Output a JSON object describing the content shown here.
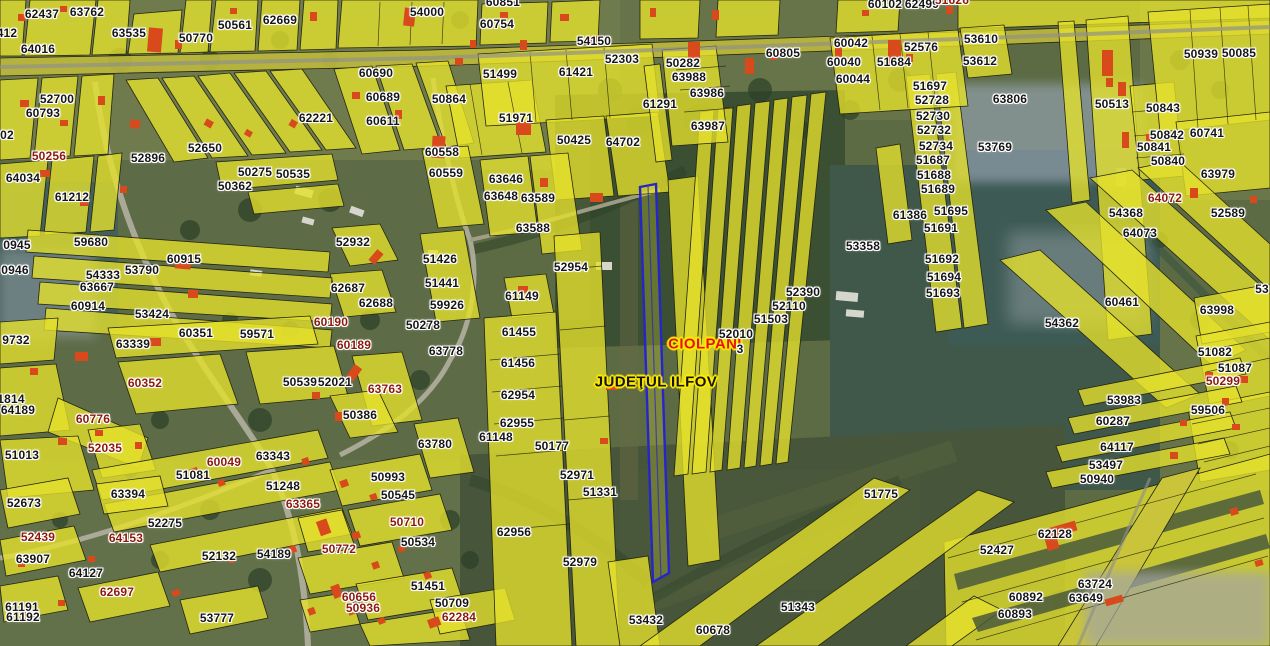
{
  "map": {
    "type": "cadastral-parcel-viewer",
    "basemap": "aerial-orthophoto",
    "overlay": "cadastral-parcels-yellow",
    "selected_parcel_outline": "#2525cc"
  },
  "colors": {
    "parcel_fill": "#e6e22c",
    "parcel_stroke": "#25250f",
    "building_red": "#d84a1c",
    "label_black": "#161616",
    "label_red": "#8c1a0c",
    "label_halo": "#ffffff",
    "town_red": "#e81212",
    "halo_yellow": "#ffec00",
    "selected_blue": "#2525cc"
  },
  "place_labels": [
    {
      "text": "CIOLPANI",
      "x": 705,
      "y": 344,
      "type": "locality"
    },
    {
      "text": "JUDEŢUL ILFOV",
      "x": 656,
      "y": 382,
      "type": "county"
    }
  ],
  "parcel_labels": [
    {
      "t": "62437",
      "x": 42,
      "y": 14
    },
    {
      "t": "63762",
      "x": 87,
      "y": 12
    },
    {
      "t": "412",
      "x": 7,
      "y": 33
    },
    {
      "t": "64016",
      "x": 38,
      "y": 49
    },
    {
      "t": "63535",
      "x": 129,
      "y": 33
    },
    {
      "t": "50770",
      "x": 196,
      "y": 38
    },
    {
      "t": "50561",
      "x": 235,
      "y": 25
    },
    {
      "t": "62669",
      "x": 280,
      "y": 20
    },
    {
      "t": "54000",
      "x": 427,
      "y": 12
    },
    {
      "t": "60851",
      "x": 503,
      "y": 2
    },
    {
      "t": "60754",
      "x": 497,
      "y": 24
    },
    {
      "t": "54150",
      "x": 594,
      "y": 41
    },
    {
      "t": "52303",
      "x": 622,
      "y": 59
    },
    {
      "t": "60102",
      "x": 885,
      "y": 4
    },
    {
      "t": "62499",
      "x": 922,
      "y": 4
    },
    {
      "t": "51626",
      "x": 952,
      "y": 0,
      "r": 1
    },
    {
      "t": "60805",
      "x": 783,
      "y": 53
    },
    {
      "t": "60042",
      "x": 851,
      "y": 43
    },
    {
      "t": "60040",
      "x": 844,
      "y": 62
    },
    {
      "t": "60044",
      "x": 853,
      "y": 79
    },
    {
      "t": "51684",
      "x": 894,
      "y": 62
    },
    {
      "t": "52576",
      "x": 921,
      "y": 47
    },
    {
      "t": "53610",
      "x": 981,
      "y": 39
    },
    {
      "t": "53612",
      "x": 980,
      "y": 61
    },
    {
      "t": "50939",
      "x": 1201,
      "y": 54
    },
    {
      "t": "50085",
      "x": 1239,
      "y": 53
    },
    {
      "t": "50282",
      "x": 683,
      "y": 63
    },
    {
      "t": "63988",
      "x": 689,
      "y": 77
    },
    {
      "t": "63986",
      "x": 707,
      "y": 93
    },
    {
      "t": "63987",
      "x": 708,
      "y": 126
    },
    {
      "t": "61291",
      "x": 660,
      "y": 104
    },
    {
      "t": "63806",
      "x": 1010,
      "y": 99
    },
    {
      "t": "51697",
      "x": 930,
      "y": 86
    },
    {
      "t": "52728",
      "x": 932,
      "y": 100
    },
    {
      "t": "52730",
      "x": 933,
      "y": 116
    },
    {
      "t": "52732",
      "x": 934,
      "y": 130
    },
    {
      "t": "52734",
      "x": 936,
      "y": 146
    },
    {
      "t": "51687",
      "x": 933,
      "y": 160
    },
    {
      "t": "51688",
      "x": 934,
      "y": 175
    },
    {
      "t": "51689",
      "x": 938,
      "y": 189
    },
    {
      "t": "50513",
      "x": 1112,
      "y": 104
    },
    {
      "t": "50843",
      "x": 1163,
      "y": 108
    },
    {
      "t": "50842",
      "x": 1167,
      "y": 135
    },
    {
      "t": "50841",
      "x": 1154,
      "y": 147
    },
    {
      "t": "50840",
      "x": 1168,
      "y": 161
    },
    {
      "t": "60741",
      "x": 1207,
      "y": 133
    },
    {
      "t": "63979",
      "x": 1218,
      "y": 174
    },
    {
      "t": "52700",
      "x": 57,
      "y": 99
    },
    {
      "t": "60793",
      "x": 43,
      "y": 113
    },
    {
      "t": "02",
      "x": 7,
      "y": 135
    },
    {
      "t": "50256",
      "x": 49,
      "y": 156,
      "r": 1
    },
    {
      "t": "52896",
      "x": 148,
      "y": 158
    },
    {
      "t": "52650",
      "x": 205,
      "y": 148
    },
    {
      "t": "62221",
      "x": 316,
      "y": 118
    },
    {
      "t": "60690",
      "x": 376,
      "y": 73
    },
    {
      "t": "60689",
      "x": 383,
      "y": 97
    },
    {
      "t": "60611",
      "x": 383,
      "y": 121
    },
    {
      "t": "50864",
      "x": 449,
      "y": 99
    },
    {
      "t": "51499",
      "x": 500,
      "y": 74
    },
    {
      "t": "51971",
      "x": 516,
      "y": 118
    },
    {
      "t": "61421",
      "x": 576,
      "y": 72
    },
    {
      "t": "60558",
      "x": 442,
      "y": 152
    },
    {
      "t": "60559",
      "x": 446,
      "y": 173
    },
    {
      "t": "50425",
      "x": 574,
      "y": 140
    },
    {
      "t": "64702",
      "x": 623,
      "y": 142
    },
    {
      "t": "63646",
      "x": 506,
      "y": 179
    },
    {
      "t": "63648",
      "x": 501,
      "y": 196
    },
    {
      "t": "63589",
      "x": 538,
      "y": 198
    },
    {
      "t": "63588",
      "x": 533,
      "y": 228
    },
    {
      "t": "50275",
      "x": 255,
      "y": 172
    },
    {
      "t": "50362",
      "x": 235,
      "y": 186
    },
    {
      "t": "50535",
      "x": 293,
      "y": 174
    },
    {
      "t": "64034",
      "x": 23,
      "y": 178
    },
    {
      "t": "61212",
      "x": 72,
      "y": 197
    },
    {
      "t": "53769",
      "x": 995,
      "y": 147
    },
    {
      "t": "59680",
      "x": 91,
      "y": 242
    },
    {
      "t": "53790",
      "x": 142,
      "y": 270
    },
    {
      "t": "54333",
      "x": 103,
      "y": 275
    },
    {
      "t": "63667",
      "x": 97,
      "y": 287
    },
    {
      "t": "60914",
      "x": 88,
      "y": 306
    },
    {
      "t": "53424",
      "x": 152,
      "y": 314
    },
    {
      "t": "60915",
      "x": 184,
      "y": 259
    },
    {
      "t": "52932",
      "x": 353,
      "y": 242
    },
    {
      "t": "51426",
      "x": 440,
      "y": 259
    },
    {
      "t": "51441",
      "x": 442,
      "y": 283
    },
    {
      "t": "59926",
      "x": 447,
      "y": 305
    },
    {
      "t": "62687",
      "x": 348,
      "y": 288
    },
    {
      "t": "62688",
      "x": 376,
      "y": 303
    },
    {
      "t": "52954",
      "x": 571,
      "y": 267
    },
    {
      "t": "61149",
      "x": 522,
      "y": 296
    },
    {
      "t": "53358",
      "x": 863,
      "y": 246
    },
    {
      "t": "61386",
      "x": 910,
      "y": 215
    },
    {
      "t": "51695",
      "x": 951,
      "y": 211
    },
    {
      "t": "51691",
      "x": 941,
      "y": 228
    },
    {
      "t": "51692",
      "x": 942,
      "y": 259
    },
    {
      "t": "51694",
      "x": 944,
      "y": 277
    },
    {
      "t": "51693",
      "x": 943,
      "y": 293
    },
    {
      "t": "52390",
      "x": 803,
      "y": 292
    },
    {
      "t": "52110",
      "x": 789,
      "y": 306
    },
    {
      "t": "51503",
      "x": 771,
      "y": 319
    },
    {
      "t": "52010",
      "x": 736,
      "y": 334
    },
    {
      "t": "3",
      "x": 740,
      "y": 349
    },
    {
      "t": "54368",
      "x": 1126,
      "y": 213
    },
    {
      "t": "64072",
      "x": 1165,
      "y": 198,
      "r": 1
    },
    {
      "t": "64073",
      "x": 1140,
      "y": 233
    },
    {
      "t": "52589",
      "x": 1228,
      "y": 213
    },
    {
      "t": "60461",
      "x": 1122,
      "y": 302
    },
    {
      "t": "54362",
      "x": 1062,
      "y": 323
    },
    {
      "t": "63998",
      "x": 1217,
      "y": 310
    },
    {
      "t": "0945",
      "x": 17,
      "y": 245
    },
    {
      "t": "0946",
      "x": 15,
      "y": 270
    },
    {
      "t": "60190",
      "x": 331,
      "y": 322,
      "r": 1
    },
    {
      "t": "60189",
      "x": 354,
      "y": 345,
      "r": 1
    },
    {
      "t": "50278",
      "x": 423,
      "y": 325
    },
    {
      "t": "63778",
      "x": 446,
      "y": 351
    },
    {
      "t": "61455",
      "x": 519,
      "y": 332
    },
    {
      "t": "61456",
      "x": 518,
      "y": 363
    },
    {
      "t": "62954",
      "x": 518,
      "y": 395
    },
    {
      "t": "62955",
      "x": 517,
      "y": 423
    },
    {
      "t": "61148",
      "x": 496,
      "y": 437
    },
    {
      "t": "50177",
      "x": 552,
      "y": 446
    },
    {
      "t": "9732",
      "x": 16,
      "y": 340
    },
    {
      "t": "63339",
      "x": 133,
      "y": 344
    },
    {
      "t": "60351",
      "x": 196,
      "y": 333
    },
    {
      "t": "59571",
      "x": 257,
      "y": 334
    },
    {
      "t": "60352",
      "x": 145,
      "y": 383,
      "r": 1
    },
    {
      "t": "50539",
      "x": 300,
      "y": 382
    },
    {
      "t": "52021",
      "x": 335,
      "y": 382
    },
    {
      "t": "1814",
      "x": 11,
      "y": 399
    },
    {
      "t": "64189",
      "x": 18,
      "y": 410
    },
    {
      "t": "60776",
      "x": 93,
      "y": 419,
      "r": 1
    },
    {
      "t": "51013",
      "x": 22,
      "y": 455
    },
    {
      "t": "52035",
      "x": 105,
      "y": 448,
      "r": 1
    },
    {
      "t": "63763",
      "x": 385,
      "y": 389,
      "r": 1
    },
    {
      "t": "50386",
      "x": 360,
      "y": 415
    },
    {
      "t": "63780",
      "x": 435,
      "y": 444
    },
    {
      "t": "60049",
      "x": 224,
      "y": 462,
      "r": 1
    },
    {
      "t": "63343",
      "x": 273,
      "y": 456
    },
    {
      "t": "51081",
      "x": 193,
      "y": 475
    },
    {
      "t": "50993",
      "x": 388,
      "y": 477
    },
    {
      "t": "51248",
      "x": 283,
      "y": 486
    },
    {
      "t": "50545",
      "x": 398,
      "y": 495
    },
    {
      "t": "52971",
      "x": 577,
      "y": 475
    },
    {
      "t": "51331",
      "x": 600,
      "y": 492
    },
    {
      "t": "51082",
      "x": 1215,
      "y": 352
    },
    {
      "t": "51087",
      "x": 1235,
      "y": 368
    },
    {
      "t": "50299",
      "x": 1223,
      "y": 381,
      "r": 1
    },
    {
      "t": "53983",
      "x": 1124,
      "y": 400
    },
    {
      "t": "59506",
      "x": 1208,
      "y": 410
    },
    {
      "t": "60287",
      "x": 1113,
      "y": 421
    },
    {
      "t": "64117",
      "x": 1117,
      "y": 447
    },
    {
      "t": "53497",
      "x": 1106,
      "y": 465
    },
    {
      "t": "50940",
      "x": 1097,
      "y": 479
    },
    {
      "t": "51775",
      "x": 881,
      "y": 494
    },
    {
      "t": "63394",
      "x": 128,
      "y": 494
    },
    {
      "t": "52673",
      "x": 24,
      "y": 503
    },
    {
      "t": "63365",
      "x": 303,
      "y": 504,
      "r": 1
    },
    {
      "t": "52439",
      "x": 38,
      "y": 537,
      "r": 1
    },
    {
      "t": "52275",
      "x": 165,
      "y": 523
    },
    {
      "t": "64153",
      "x": 126,
      "y": 538,
      "r": 1
    },
    {
      "t": "63907",
      "x": 33,
      "y": 559
    },
    {
      "t": "64127",
      "x": 86,
      "y": 573
    },
    {
      "t": "62697",
      "x": 117,
      "y": 592,
      "r": 1
    },
    {
      "t": "61191",
      "x": 22,
      "y": 607
    },
    {
      "t": "61192",
      "x": 23,
      "y": 617
    },
    {
      "t": "53777",
      "x": 217,
      "y": 618
    },
    {
      "t": "52132",
      "x": 219,
      "y": 556
    },
    {
      "t": "54189",
      "x": 274,
      "y": 554
    },
    {
      "t": "50710",
      "x": 407,
      "y": 522,
      "r": 1
    },
    {
      "t": "50534",
      "x": 418,
      "y": 542
    },
    {
      "t": "50772",
      "x": 339,
      "y": 549,
      "r": 1
    },
    {
      "t": "62956",
      "x": 514,
      "y": 532
    },
    {
      "t": "52979",
      "x": 580,
      "y": 562
    },
    {
      "t": "51451",
      "x": 428,
      "y": 586
    },
    {
      "t": "60656",
      "x": 359,
      "y": 597,
      "r": 1
    },
    {
      "t": "50936",
      "x": 363,
      "y": 608,
      "r": 1
    },
    {
      "t": "50709",
      "x": 452,
      "y": 603
    },
    {
      "t": "62284",
      "x": 459,
      "y": 617,
      "r": 1
    },
    {
      "t": "53432",
      "x": 646,
      "y": 620
    },
    {
      "t": "60678",
      "x": 713,
      "y": 630
    },
    {
      "t": "51343",
      "x": 798,
      "y": 607
    },
    {
      "t": "62128",
      "x": 1055,
      "y": 534
    },
    {
      "t": "52427",
      "x": 997,
      "y": 550
    },
    {
      "t": "63724",
      "x": 1095,
      "y": 584
    },
    {
      "t": "63649",
      "x": 1086,
      "y": 598
    },
    {
      "t": "60892",
      "x": 1026,
      "y": 597
    },
    {
      "t": "60893",
      "x": 1015,
      "y": 614
    },
    {
      "t": "53",
      "x": 1262,
      "y": 289
    }
  ]
}
